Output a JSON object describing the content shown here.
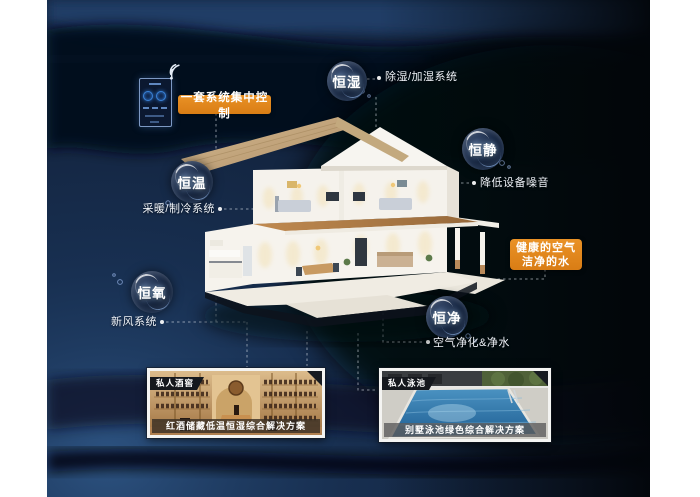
{
  "poster": {
    "control_panel": {
      "label": "一套系统集中控制"
    },
    "healthy_box": {
      "line1": "健康的空气",
      "line2": "洁净的水"
    },
    "bubbles": [
      {
        "name": "恒湿",
        "desc": "除湿/加湿系统"
      },
      {
        "name": "恒静",
        "desc": "降低设备噪音"
      },
      {
        "name": "恒温",
        "desc": "采暖/制冷系统"
      },
      {
        "name": "恒氧",
        "desc": "新风系统"
      },
      {
        "name": "恒净",
        "desc": "空气净化&净水"
      }
    ],
    "cards": [
      {
        "tag": "私人酒窖",
        "caption": "红酒储藏低温恒湿综合解决方案"
      },
      {
        "tag": "私人泳池",
        "caption": "别墅泳池绿色综合解决方案"
      }
    ],
    "colors": {
      "accent_orange": "#DE861F",
      "canvas_navy": "#0E1C31",
      "text_white": "#FFFFFF"
    }
  }
}
